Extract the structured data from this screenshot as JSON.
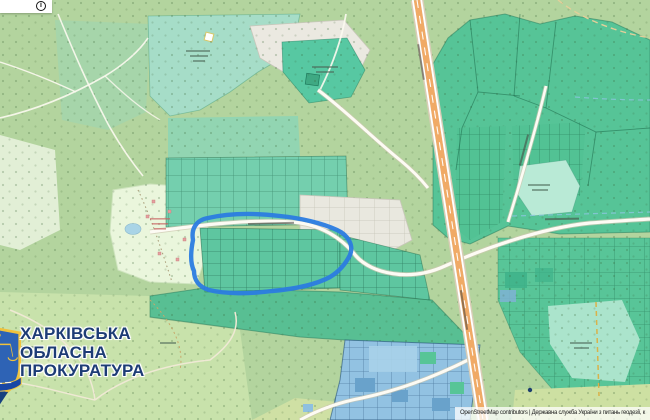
{
  "map": {
    "info_button_glyph": "i",
    "watermark": {
      "lines": [
        "ХАРКІВСЬКА",
        "ОБЛАСНА",
        "ПРОКУРАТУРА"
      ],
      "text_color": "#1d3c75"
    },
    "attribution": "OpenStreetMap contributors | Державна служба України з питань геодезії, к",
    "highlight": {
      "type": "hand-drawn-outline",
      "color": "#2b7ce0"
    },
    "colors": {
      "forest_base": "#b3d49e",
      "park_light": "#c8e2ab",
      "parcel_teal": "#5ec6a0",
      "parcel_teal_light": "#a6ddc8",
      "parcel_green_large": "#57c499",
      "parcel_blue": "#92c2e2",
      "gray_area": "#ebe9e1",
      "camp_area": "#eaf6dc",
      "highway_orange": "#f0aa66",
      "road_white": "#fdfbf4"
    }
  }
}
